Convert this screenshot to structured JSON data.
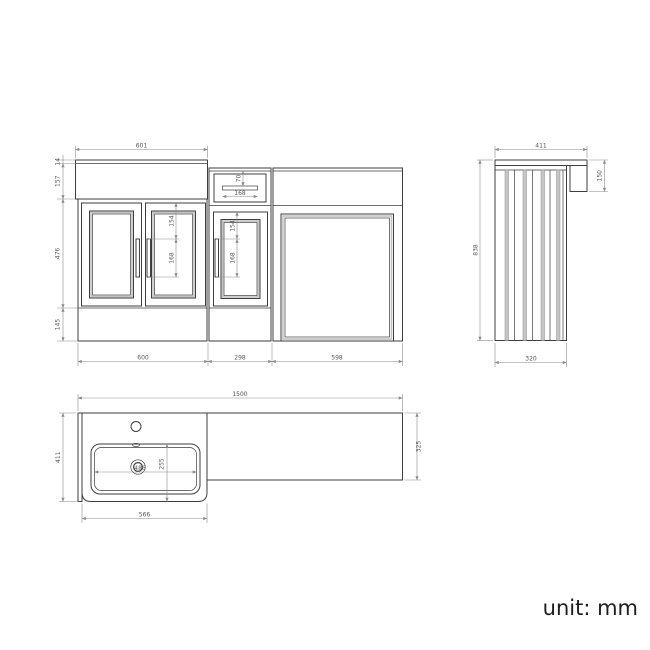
{
  "unit_label": "unit: mm",
  "front_view": {
    "worktop_width": "601",
    "worktop_edge": "14",
    "basin_height": "157",
    "door_height": "476",
    "plinth_height": "145",
    "left_unit_width": "600",
    "mid_unit_width": "298",
    "right_unit_width": "598",
    "drawer_recess_height": "70",
    "drawer_recess_width": "168",
    "left_handle_offset": "154",
    "left_handle_length": "168",
    "mid_handle_offset": "154",
    "mid_handle_length": "168"
  },
  "side_view": {
    "worktop_depth": "411",
    "worktop_return": "150",
    "overall_height": "838",
    "cabinet_depth": "320"
  },
  "plan_view": {
    "worktop_length": "1500",
    "left_section_depth": "411",
    "right_section_depth": "325",
    "bowl_width": "486",
    "bowl_depth": "255",
    "basin_section_width": "566"
  }
}
